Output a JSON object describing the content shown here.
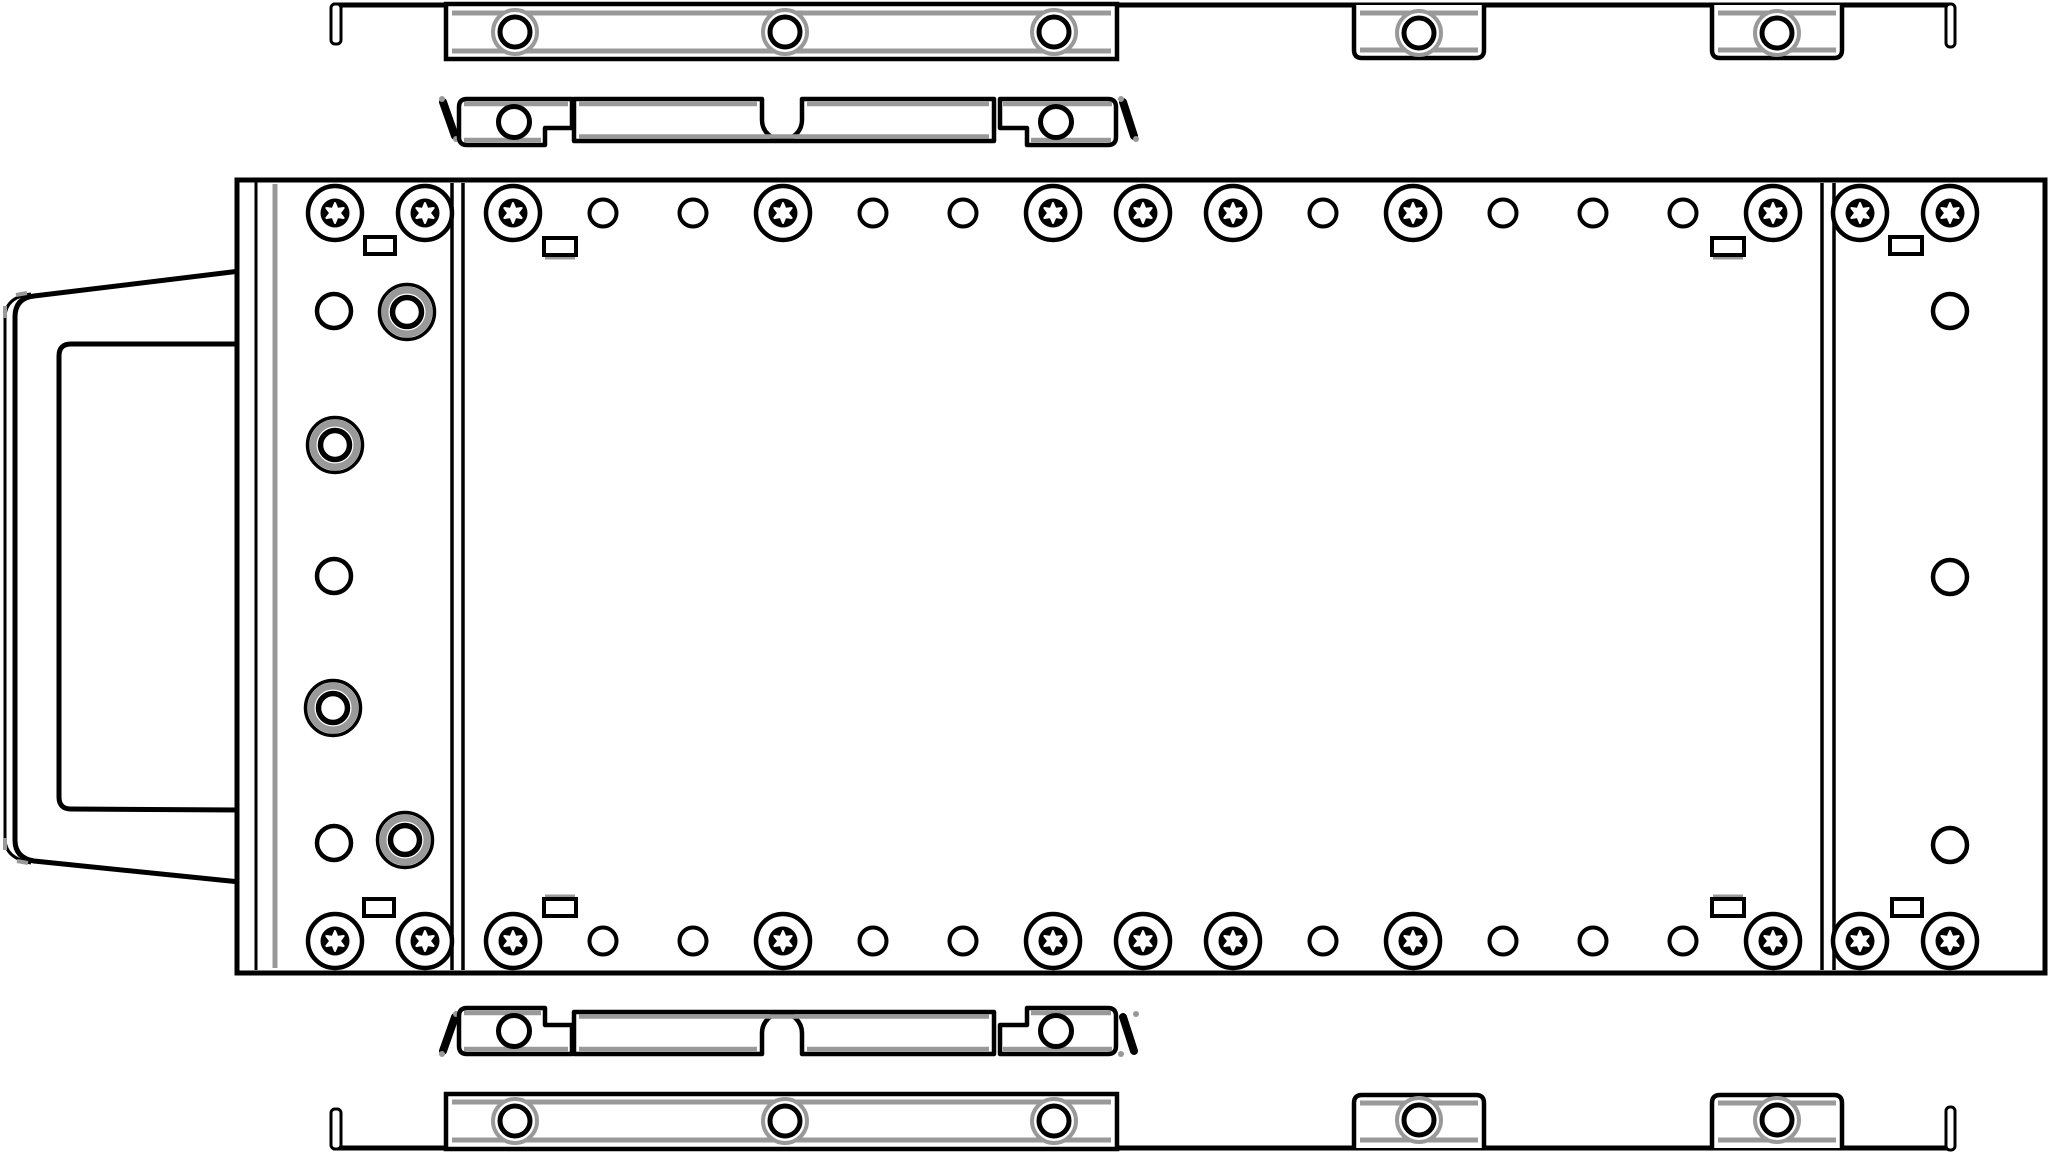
{
  "canvas": {
    "w": 2048,
    "h": 1154
  },
  "palette": {
    "ink": "#000000",
    "grey": "#999999",
    "white": "#ffffff"
  },
  "parts": [
    {
      "name": "front-bezel-handle",
      "shapes": [
        {
          "k": "path",
          "d": "M240,271 L34,296 Q15,298 15,317 L15,840 Q15,858 34,861 L240,882 Z",
          "sw": 5,
          "fill": "white"
        },
        {
          "k": "path",
          "d": "M31,294 Q5,297 5,318 L5,839 Q5,858 31,863",
          "sw": 3
        },
        {
          "k": "line",
          "x1": 16,
          "y1": 295,
          "x2": 27,
          "y2": 293,
          "sw": 4,
          "col": "grey"
        },
        {
          "k": "line",
          "x1": 5,
          "y1": 306,
          "x2": 5,
          "y2": 318,
          "sw": 4,
          "col": "grey"
        },
        {
          "k": "line",
          "x1": 5,
          "y1": 838,
          "x2": 5,
          "y2": 850,
          "sw": 4,
          "col": "grey"
        },
        {
          "k": "line",
          "x1": 17,
          "y1": 861,
          "x2": 28,
          "y2": 863,
          "sw": 4,
          "col": "grey"
        },
        {
          "k": "path",
          "d": "M240,344 L71,344 Q59,344 59,356 L59,797 Q59,809 71,809 L240,810",
          "sw": 5
        }
      ]
    },
    {
      "name": "chassis-body",
      "shapes": [
        {
          "k": "rect",
          "x": 237,
          "y": 180,
          "w": 1808,
          "h": 793,
          "sw": 5,
          "fill": "white"
        },
        {
          "k": "line",
          "x1": 256,
          "y1": 182,
          "x2": 256,
          "y2": 970,
          "sw": 3
        },
        {
          "k": "line",
          "x1": 275,
          "y1": 184,
          "x2": 275,
          "y2": 968,
          "sw": 5,
          "col": "grey"
        },
        {
          "k": "line",
          "x1": 452,
          "y1": 183,
          "x2": 452,
          "y2": 970,
          "sw": 3.5
        },
        {
          "k": "line",
          "x1": 463,
          "y1": 183,
          "x2": 463,
          "y2": 970,
          "sw": 3.5
        },
        {
          "k": "line",
          "x1": 1822,
          "y1": 183,
          "x2": 1822,
          "y2": 970,
          "sw": 3.5
        },
        {
          "k": "line",
          "x1": 1834,
          "y1": 183,
          "x2": 1834,
          "y2": 970,
          "sw": 3.5
        },
        {
          "k": "torx",
          "cx": 335,
          "cy": 213
        },
        {
          "k": "torx",
          "cx": 425,
          "cy": 213
        },
        {
          "k": "torx",
          "cx": 335,
          "cy": 941
        },
        {
          "k": "torx",
          "cx": 425,
          "cy": 941
        },
        {
          "k": "torx",
          "cx": 1860,
          "cy": 213
        },
        {
          "k": "torx",
          "cx": 1950,
          "cy": 213
        },
        {
          "k": "torx",
          "cx": 1860,
          "cy": 941
        },
        {
          "k": "torx",
          "cx": 1950,
          "cy": 941
        },
        {
          "k": "slot",
          "x": 365,
          "y": 237,
          "w": 30,
          "h": 17
        },
        {
          "k": "slot",
          "x": 364,
          "y": 899,
          "w": 30,
          "h": 17
        },
        {
          "k": "slot",
          "x": 544,
          "y": 238,
          "w": 32,
          "h": 17,
          "edge": "bottom"
        },
        {
          "k": "slot",
          "x": 1712,
          "y": 238,
          "w": 32,
          "h": 17,
          "edge": "bottom"
        },
        {
          "k": "slot",
          "x": 544,
          "y": 899,
          "w": 32,
          "h": 17,
          "edge": "top"
        },
        {
          "k": "slot",
          "x": 1712,
          "y": 899,
          "w": 32,
          "h": 17,
          "edge": "top"
        },
        {
          "k": "slot",
          "x": 1890,
          "y": 237,
          "w": 32,
          "h": 17
        },
        {
          "k": "slot",
          "x": 1892,
          "y": 899,
          "w": 30,
          "h": 17
        },
        {
          "k": "pcircle",
          "cx": 334,
          "cy": 311
        },
        {
          "k": "grommet",
          "cx": 407,
          "cy": 312
        },
        {
          "k": "grommet",
          "cx": 335,
          "cy": 445
        },
        {
          "k": "pcircle",
          "cx": 334,
          "cy": 576
        },
        {
          "k": "grommet",
          "cx": 333,
          "cy": 708
        },
        {
          "k": "pcircle",
          "cx": 334,
          "cy": 843
        },
        {
          "k": "grommet",
          "cx": 405,
          "cy": 840
        },
        {
          "k": "pcircle",
          "cx": 1950,
          "cy": 311
        },
        {
          "k": "pcircle",
          "cx": 1950,
          "cy": 577
        },
        {
          "k": "pcircle",
          "cx": 1950,
          "cy": 845
        },
        {
          "k": "torx",
          "cx": 513,
          "cy": 213
        },
        {
          "k": "hole",
          "cx": 603,
          "cy": 213
        },
        {
          "k": "hole",
          "cx": 693,
          "cy": 213
        },
        {
          "k": "torx",
          "cx": 783,
          "cy": 213
        },
        {
          "k": "hole",
          "cx": 873,
          "cy": 213
        },
        {
          "k": "hole",
          "cx": 963,
          "cy": 213
        },
        {
          "k": "torx",
          "cx": 1053,
          "cy": 213
        },
        {
          "k": "torx",
          "cx": 1143,
          "cy": 213
        },
        {
          "k": "torx",
          "cx": 1233,
          "cy": 213
        },
        {
          "k": "hole",
          "cx": 1323,
          "cy": 213
        },
        {
          "k": "torx",
          "cx": 1413,
          "cy": 213
        },
        {
          "k": "hole",
          "cx": 1503,
          "cy": 213
        },
        {
          "k": "hole",
          "cx": 1593,
          "cy": 213
        },
        {
          "k": "hole",
          "cx": 1683,
          "cy": 213
        },
        {
          "k": "torx",
          "cx": 1773,
          "cy": 213
        },
        {
          "k": "torx",
          "cx": 513,
          "cy": 941
        },
        {
          "k": "hole",
          "cx": 603,
          "cy": 941
        },
        {
          "k": "hole",
          "cx": 693,
          "cy": 941
        },
        {
          "k": "torx",
          "cx": 783,
          "cy": 941
        },
        {
          "k": "hole",
          "cx": 873,
          "cy": 941
        },
        {
          "k": "hole",
          "cx": 963,
          "cy": 941
        },
        {
          "k": "torx",
          "cx": 1053,
          "cy": 941
        },
        {
          "k": "torx",
          "cx": 1143,
          "cy": 941
        },
        {
          "k": "torx",
          "cx": 1233,
          "cy": 941
        },
        {
          "k": "hole",
          "cx": 1323,
          "cy": 941
        },
        {
          "k": "torx",
          "cx": 1413,
          "cy": 941
        },
        {
          "k": "hole",
          "cx": 1503,
          "cy": 941
        },
        {
          "k": "hole",
          "cx": 1593,
          "cy": 941
        },
        {
          "k": "hole",
          "cx": 1683,
          "cy": 941
        },
        {
          "k": "torx",
          "cx": 1773,
          "cy": 941
        }
      ]
    },
    {
      "name": "top-mounting-rail",
      "shapes": [
        {
          "k": "line",
          "x1": 333,
          "y1": 5,
          "x2": 1952,
          "y2": 5,
          "sw": 5
        },
        {
          "k": "rect",
          "x": 331,
          "y": 4,
          "w": 10,
          "h": 40,
          "rx": 4,
          "sw": 3,
          "fill": "white"
        },
        {
          "k": "rect",
          "x": 446,
          "y": 4,
          "w": 671,
          "h": 55,
          "sw": 4.5,
          "fill": "white"
        },
        {
          "k": "line",
          "x1": 452,
          "y1": 13,
          "x2": 1111,
          "y2": 13,
          "sw": 5,
          "col": "grey"
        },
        {
          "k": "line",
          "x1": 452,
          "y1": 51,
          "x2": 1111,
          "y2": 51,
          "sw": 5,
          "col": "grey"
        },
        {
          "k": "railhole",
          "cx": 515,
          "cy": 32
        },
        {
          "k": "railhole",
          "cx": 785,
          "cy": 32
        },
        {
          "k": "railhole",
          "cx": 1054,
          "cy": 32
        },
        {
          "k": "path",
          "d": "M1354,5 L1354,50 Q1354,58 1362,58 L1476,58 Q1484,58 1484,50 L1484,5",
          "sw": 4.5,
          "fill": "white"
        },
        {
          "k": "line",
          "x1": 1360,
          "y1": 13,
          "x2": 1478,
          "y2": 13,
          "sw": 5,
          "col": "grey"
        },
        {
          "k": "line",
          "x1": 1360,
          "y1": 50,
          "x2": 1478,
          "y2": 50,
          "sw": 5,
          "col": "grey"
        },
        {
          "k": "railhole",
          "cx": 1419,
          "cy": 33
        },
        {
          "k": "path",
          "d": "M1712,5 L1712,50 Q1712,58 1720,58 L1834,58 Q1842,58 1842,50 L1842,5",
          "sw": 4.5,
          "fill": "white"
        },
        {
          "k": "line",
          "x1": 1718,
          "y1": 13,
          "x2": 1836,
          "y2": 13,
          "sw": 5,
          "col": "grey"
        },
        {
          "k": "line",
          "x1": 1718,
          "y1": 50,
          "x2": 1836,
          "y2": 50,
          "sw": 5,
          "col": "grey"
        },
        {
          "k": "railhole",
          "cx": 1777,
          "cy": 33
        },
        {
          "k": "rect",
          "x": 1946,
          "y": 4,
          "w": 9,
          "h": 43,
          "rx": 4,
          "sw": 3,
          "fill": "white"
        }
      ]
    },
    {
      "name": "top-latch-bracket",
      "shapes": [
        {
          "k": "line",
          "x1": 443,
          "y1": 102,
          "x2": 455,
          "y2": 136,
          "sw": 8,
          "cap": "round"
        },
        {
          "k": "circle",
          "cx": 442,
          "cy": 99,
          "r": 3,
          "fillcol": "grey"
        },
        {
          "k": "circle",
          "cx": 456,
          "cy": 139,
          "r": 3,
          "fillcol": "grey"
        },
        {
          "k": "path",
          "d": "M572,99 L572,128 L545,128 L545,145 L467,145 Q459,145 459,137 L459,107 Q459,99 467,99 L572,99 Z",
          "sw": 4.5,
          "fill": "white"
        },
        {
          "k": "line",
          "x1": 464,
          "y1": 104,
          "x2": 568,
          "y2": 104,
          "sw": 4.5,
          "col": "grey"
        },
        {
          "k": "line",
          "x1": 464,
          "y1": 140,
          "x2": 541,
          "y2": 140,
          "sw": 4.5,
          "col": "grey"
        },
        {
          "k": "circle",
          "cx": 514,
          "cy": 122,
          "r": 15.5,
          "sw": 5
        },
        {
          "k": "path",
          "d": "M574,99 L762,99 L762,120 A20 20 0 0 0 802,120 L802,99 L994,99 L994,141 L574,141 Z",
          "sw": 4.5,
          "fill": "white"
        },
        {
          "k": "line",
          "x1": 579,
          "y1": 104,
          "x2": 757,
          "y2": 104,
          "sw": 4.5,
          "col": "grey"
        },
        {
          "k": "line",
          "x1": 807,
          "y1": 104,
          "x2": 989,
          "y2": 104,
          "sw": 4.5,
          "col": "grey"
        },
        {
          "k": "line",
          "x1": 579,
          "y1": 136.5,
          "x2": 989,
          "y2": 136.5,
          "sw": 4.5,
          "col": "grey"
        },
        {
          "k": "path",
          "d": "M1000,99 L1108,99 Q1116,99 1116,107 L1116,137 Q1116,145 1108,145 L1027,145 L1027,128 L1000,128 Z",
          "sw": 4.5,
          "fill": "white"
        },
        {
          "k": "line",
          "x1": 1003,
          "y1": 104,
          "x2": 1112,
          "y2": 104,
          "sw": 4.5,
          "col": "grey"
        },
        {
          "k": "line",
          "x1": 1031,
          "y1": 140,
          "x2": 1111,
          "y2": 140,
          "sw": 4.5,
          "col": "grey"
        },
        {
          "k": "circle",
          "cx": 1056,
          "cy": 122,
          "r": 15.5,
          "sw": 5
        },
        {
          "k": "line",
          "x1": 1123,
          "y1": 102,
          "x2": 1134,
          "y2": 136,
          "sw": 8,
          "cap": "round"
        },
        {
          "k": "circle",
          "cx": 1121,
          "cy": 99,
          "r": 3,
          "fillcol": "grey"
        },
        {
          "k": "circle",
          "cx": 1136,
          "cy": 139,
          "r": 3,
          "fillcol": "grey"
        }
      ]
    },
    {
      "name": "bottom-latch-bracket",
      "shapes": [
        {
          "k": "line",
          "x1": 455,
          "y1": 1017,
          "x2": 443,
          "y2": 1051,
          "sw": 8,
          "cap": "round"
        },
        {
          "k": "circle",
          "cx": 456,
          "cy": 1014,
          "r": 3,
          "fillcol": "grey"
        },
        {
          "k": "circle",
          "cx": 442,
          "cy": 1054,
          "r": 3,
          "fillcol": "grey"
        },
        {
          "k": "path",
          "d": "M572,1054 L572,1025 L545,1025 L545,1008 L467,1008 Q459,1008 459,1016 L459,1046 Q459,1054 467,1054 L572,1054 Z",
          "sw": 4.5,
          "fill": "white"
        },
        {
          "k": "line",
          "x1": 464,
          "y1": 1049,
          "x2": 568,
          "y2": 1049,
          "sw": 4.5,
          "col": "grey"
        },
        {
          "k": "line",
          "x1": 464,
          "y1": 1013,
          "x2": 541,
          "y2": 1013,
          "sw": 4.5,
          "col": "grey"
        },
        {
          "k": "circle",
          "cx": 514,
          "cy": 1031,
          "r": 15.5,
          "sw": 5
        },
        {
          "k": "path",
          "d": "M574,1054 L762,1054 L762,1033 A20 20 0 0 1 802,1033 L802,1054 L994,1054 L994,1012 L574,1012 Z",
          "sw": 4.5,
          "fill": "white"
        },
        {
          "k": "line",
          "x1": 579,
          "y1": 1049,
          "x2": 757,
          "y2": 1049,
          "sw": 4.5,
          "col": "grey"
        },
        {
          "k": "line",
          "x1": 807,
          "y1": 1049,
          "x2": 989,
          "y2": 1049,
          "sw": 4.5,
          "col": "grey"
        },
        {
          "k": "line",
          "x1": 579,
          "y1": 1016.5,
          "x2": 989,
          "y2": 1016.5,
          "sw": 4.5,
          "col": "grey"
        },
        {
          "k": "path",
          "d": "M1000,1054 L1108,1054 Q1116,1054 1116,1046 L1116,1016 Q1116,1008 1108,1008 L1027,1008 L1027,1025 L1000,1025 Z",
          "sw": 4.5,
          "fill": "white"
        },
        {
          "k": "line",
          "x1": 1003,
          "y1": 1049,
          "x2": 1112,
          "y2": 1049,
          "sw": 4.5,
          "col": "grey"
        },
        {
          "k": "line",
          "x1": 1031,
          "y1": 1013,
          "x2": 1111,
          "y2": 1013,
          "sw": 4.5,
          "col": "grey"
        },
        {
          "k": "circle",
          "cx": 1056,
          "cy": 1031,
          "r": 15.5,
          "sw": 5
        },
        {
          "k": "line",
          "x1": 1123,
          "y1": 1017,
          "x2": 1134,
          "y2": 1051,
          "sw": 8,
          "cap": "round"
        },
        {
          "k": "circle",
          "cx": 1136,
          "cy": 1014,
          "r": 3,
          "fillcol": "grey"
        },
        {
          "k": "circle",
          "cx": 1121,
          "cy": 1054,
          "r": 3,
          "fillcol": "grey"
        }
      ]
    },
    {
      "name": "bottom-mounting-rail",
      "shapes": [
        {
          "k": "line",
          "x1": 333,
          "y1": 1148,
          "x2": 1952,
          "y2": 1148,
          "sw": 5
        },
        {
          "k": "rect",
          "x": 331,
          "y": 1109,
          "w": 10,
          "h": 40,
          "rx": 4,
          "sw": 3,
          "fill": "white"
        },
        {
          "k": "rect",
          "x": 446,
          "y": 1094,
          "w": 671,
          "h": 55,
          "sw": 4.5,
          "fill": "white"
        },
        {
          "k": "line",
          "x1": 452,
          "y1": 1102,
          "x2": 1111,
          "y2": 1102,
          "sw": 5,
          "col": "grey"
        },
        {
          "k": "line",
          "x1": 452,
          "y1": 1140,
          "x2": 1111,
          "y2": 1140,
          "sw": 5,
          "col": "grey"
        },
        {
          "k": "railhole",
          "cx": 515,
          "cy": 1121
        },
        {
          "k": "railhole",
          "cx": 785,
          "cy": 1121
        },
        {
          "k": "railhole",
          "cx": 1054,
          "cy": 1121
        },
        {
          "k": "path",
          "d": "M1354,1148 L1354,1103 Q1354,1095 1362,1095 L1476,1095 Q1484,1095 1484,1103 L1484,1148",
          "sw": 4.5,
          "fill": "white"
        },
        {
          "k": "line",
          "x1": 1360,
          "y1": 1103,
          "x2": 1478,
          "y2": 1103,
          "sw": 5,
          "col": "grey"
        },
        {
          "k": "line",
          "x1": 1360,
          "y1": 1140,
          "x2": 1478,
          "y2": 1140,
          "sw": 5,
          "col": "grey"
        },
        {
          "k": "railhole",
          "cx": 1419,
          "cy": 1120
        },
        {
          "k": "path",
          "d": "M1712,1148 L1712,1103 Q1712,1095 1720,1095 L1834,1095 Q1842,1095 1842,1103 L1842,1148",
          "sw": 4.5,
          "fill": "white"
        },
        {
          "k": "line",
          "x1": 1718,
          "y1": 1103,
          "x2": 1836,
          "y2": 1103,
          "sw": 5,
          "col": "grey"
        },
        {
          "k": "line",
          "x1": 1718,
          "y1": 1140,
          "x2": 1836,
          "y2": 1140,
          "sw": 5,
          "col": "grey"
        },
        {
          "k": "railhole",
          "cx": 1777,
          "cy": 1120
        },
        {
          "k": "rect",
          "x": 1946,
          "y": 1107,
          "w": 9,
          "h": 43,
          "rx": 4,
          "sw": 3,
          "fill": "white"
        }
      ]
    }
  ]
}
